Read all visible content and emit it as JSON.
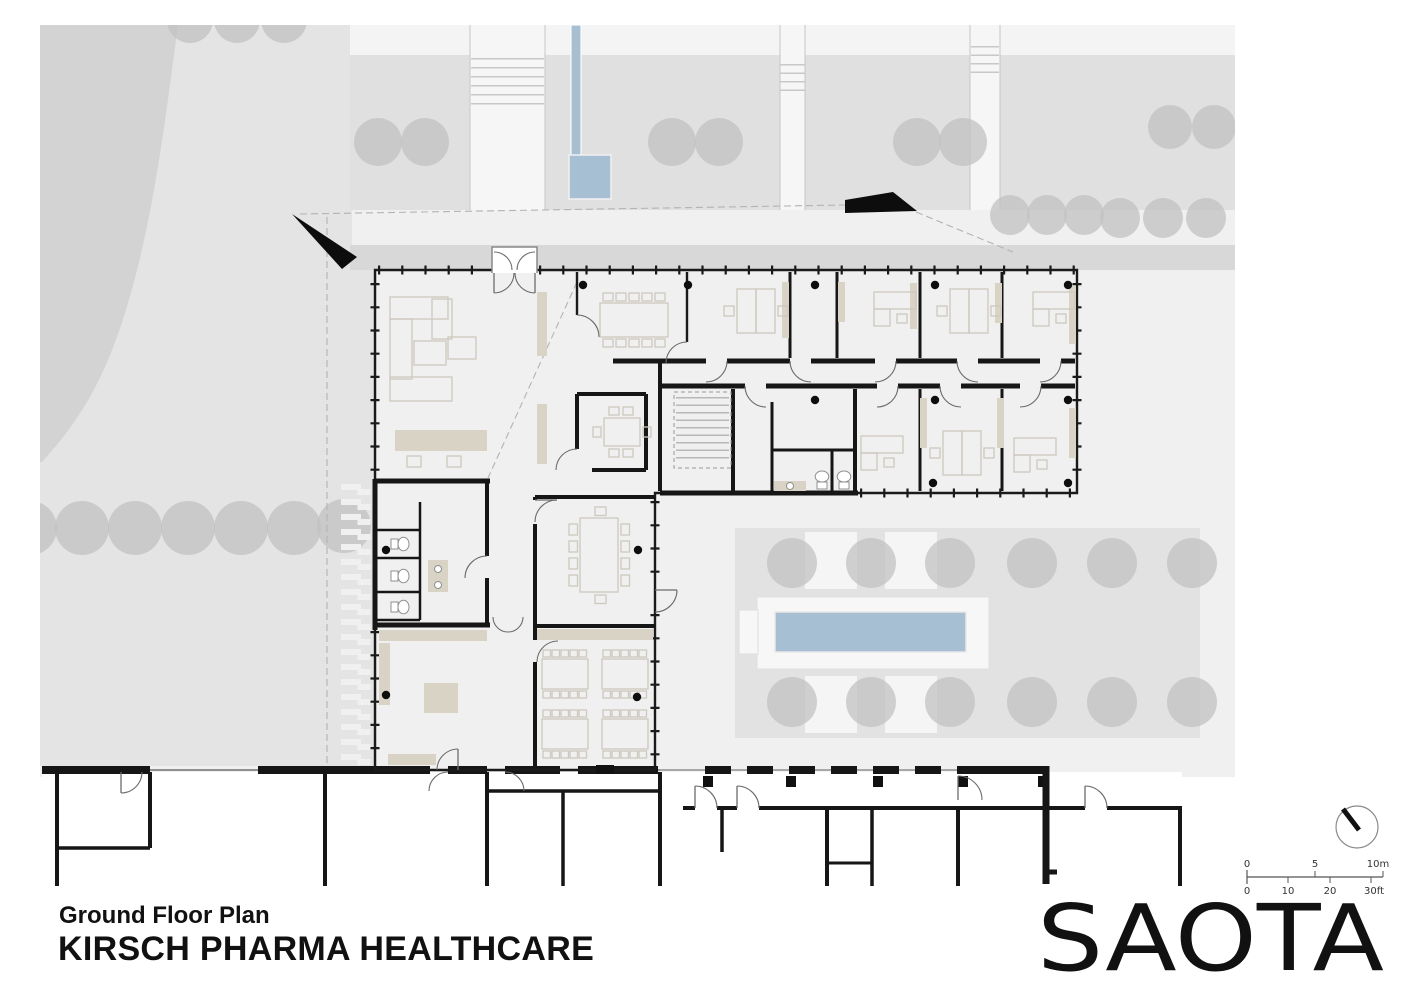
{
  "title_block": {
    "subtitle": "Ground Floor Plan",
    "title": "KIRSCH PHARMA HEALTHCARE"
  },
  "logo": {
    "text": "SAOTA"
  },
  "scale_bar": {
    "meters": {
      "m0": "0",
      "m5": "5",
      "m10": "10m"
    },
    "feet": {
      "f0": "0",
      "f10": "10",
      "f20": "20",
      "f30": "30ft"
    }
  },
  "colors": {
    "site": "#f0f0f0",
    "lawn": "#e4e4e4",
    "planting": "#e0e0e0",
    "band": "#d8d8d8",
    "courtyard": "#e2e2e2",
    "tree": "#c2c2c2",
    "water": "#a7bfd3",
    "beige": "#d9d3c5",
    "wall": "#161616"
  }
}
